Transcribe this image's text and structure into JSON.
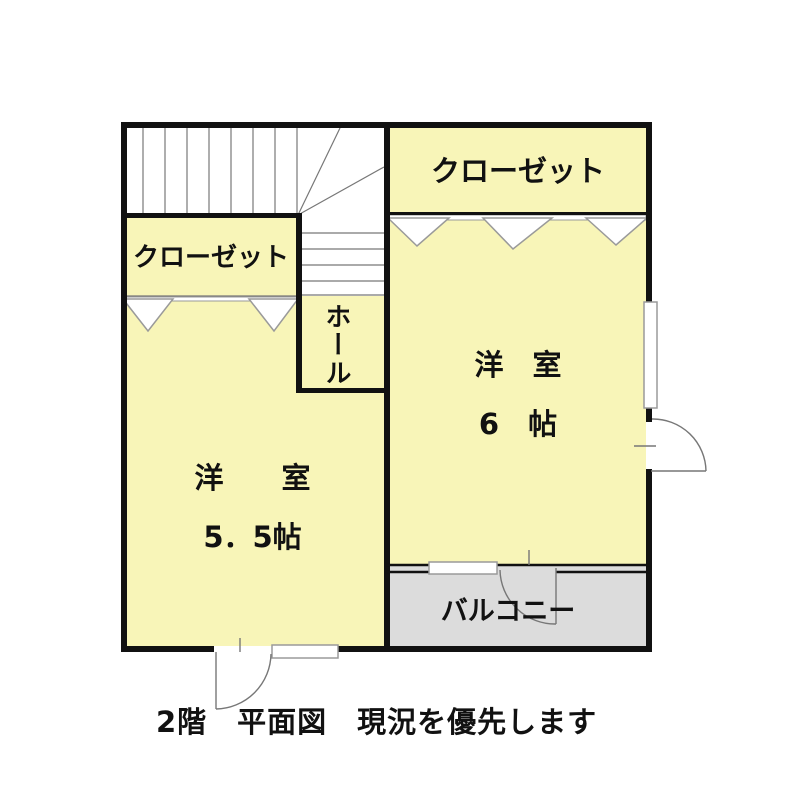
{
  "floorplan": {
    "caption": "2階　平面図　現況を優先します",
    "rooms": {
      "closet_left": {
        "label": "クローゼット"
      },
      "closet_right": {
        "label": "クローゼット"
      },
      "hall": {
        "label": "ホール"
      },
      "bedroom_right": {
        "label": "洋　室",
        "size": "6　帖"
      },
      "bedroom_left": {
        "label": "洋　　室",
        "size": "5．5帖"
      },
      "balcony": {
        "label": "バルコニー"
      }
    },
    "colors": {
      "room_fill": "#F8F5B8",
      "balcony_fill": "#DCDCDC",
      "wall": "#111111",
      "detail_line": "#777777",
      "symbol_outline": "#9A9A9A",
      "text": "#111111",
      "background": "#FFFFFF"
    }
  }
}
